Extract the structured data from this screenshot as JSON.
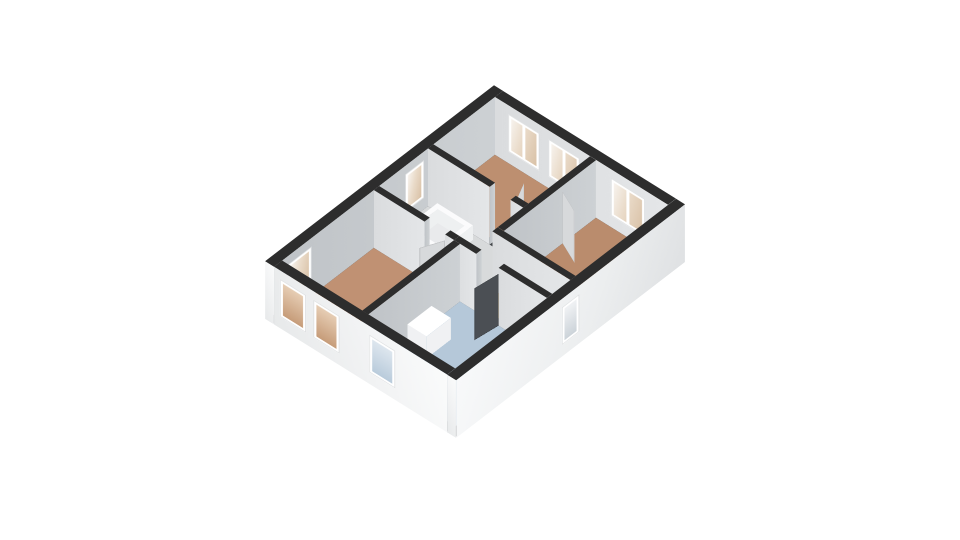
{
  "scene": {
    "background": "#ffffff",
    "projection": {
      "origin_x": 494,
      "origin_y": 143,
      "rotate_x_deg": 46.2,
      "rotate_z_deg": 42,
      "wall_height": 80
    },
    "palette": {
      "wall_top": "#2d2d2d",
      "stair_top": "#fbfbfc",
      "stair_face": "#eef0f1",
      "vanity_top": "#ffffff",
      "vanity_face": "#f0f1f3",
      "int_x": "linear-gradient(90deg,#bfc3c7,#cdd1d4)",
      "int_y": "linear-gradient(90deg,#dadcde,#e4e6e8)",
      "ext_x": "linear-gradient(115deg,#f8f9fa 0%,#eceeef 60%,#dfe1e3 100%)",
      "ext_y": "linear-gradient(65deg,#e7e9ea 0%,#f2f3f4 55%,#fafbfb 100%)",
      "floor_bedroom_top": "#bd8f70",
      "floor_bedroom_right": "#ba8c6d",
      "floor_bedroom_left": "#c09173",
      "floor_bathroom": "#b5c8d9",
      "floor_hallway": "#e2a33e",
      "floor_landing": "#d8dadb",
      "floor_stair_opening": "#e9eaec",
      "slab_shadow": "#43464a",
      "door_light": "#d7d9db",
      "door_dark": "#4b4f54",
      "window_frame": "#ffffff",
      "glass_warm": "linear-gradient(105deg,#f7f3ee 0%,#e9dac8 45%,#d9c1a6 100%)",
      "glass_tan": "linear-gradient(180deg,#e6cdb4,#c69c79)",
      "glass_blue": "linear-gradient(180deg,#dde6ee,#b9cbdb)",
      "glass_cool": "linear-gradient(180deg,#f0f2f4,#ccd3d9)"
    },
    "slab": {
      "name": "foundation-slab",
      "x": 2,
      "y": 2,
      "w": 253,
      "d": 338,
      "z": -0.6,
      "color": "slab_shadow"
    },
    "floors": [
      {
        "name": "floor-bedroom-top",
        "x": 12,
        "y": 12,
        "w": 128,
        "d": 92,
        "color": "floor_bedroom_top"
      },
      {
        "name": "floor-bedroom-right",
        "x": 148,
        "y": 12,
        "w": 97,
        "d": 138,
        "color": "floor_bedroom_right"
      },
      {
        "name": "floor-landing",
        "x": 12,
        "y": 112,
        "w": 128,
        "d": 73,
        "color": "floor_landing"
      },
      {
        "name": "floor-hallway",
        "x": 140,
        "y": 158,
        "w": 105,
        "d": 27,
        "color": "floor_hallway"
      },
      {
        "name": "floor-bedroom-left",
        "x": 12,
        "y": 193,
        "w": 108,
        "d": 137,
        "color": "floor_bedroom_left"
      },
      {
        "name": "floor-bathroom",
        "x": 128,
        "y": 193,
        "w": 117,
        "d": 137,
        "color": "floor_bathroom"
      },
      {
        "name": "floor-stair-opening",
        "x": 36,
        "y": 124,
        "w": 36,
        "d": 38,
        "z": 0.6,
        "color": "floor_stair_opening"
      }
    ],
    "walls": [
      {
        "name": "wall-exterior-north",
        "x": 12,
        "y": 0,
        "w": 233,
        "d": 12,
        "face_x": "int_x",
        "face_y": "int_y"
      },
      {
        "name": "wall-exterior-west",
        "x": 0,
        "y": 0,
        "w": 12,
        "d": 342,
        "face_x": "int_x",
        "face_y": "ext_y"
      },
      {
        "name": "wall-exterior-south",
        "x": 12,
        "y": 330,
        "w": 233,
        "d": 12,
        "face_x": "int_x",
        "face_y": "ext_y"
      },
      {
        "name": "wall-exterior-east",
        "x": 245,
        "y": 0,
        "w": 12,
        "d": 342,
        "face_x": "ext_x",
        "face_y": "ext_y"
      },
      {
        "name": "wall-bedrooms-partition",
        "x": 140,
        "y": 12,
        "w": 8,
        "d": 138,
        "face_x": "int_x",
        "face_y": "int_y"
      },
      {
        "name": "wall-bedroom-top-south-a",
        "x": 12,
        "y": 104,
        "w": 83,
        "d": 8,
        "face_x": "int_x",
        "face_y": "int_y"
      },
      {
        "name": "wall-bedroom-top-south-b",
        "x": 123,
        "y": 104,
        "w": 17,
        "d": 8,
        "face_x": "int_x",
        "face_y": "int_y"
      },
      {
        "name": "wall-hallway-north",
        "x": 140,
        "y": 150,
        "w": 105,
        "d": 8,
        "face_x": "int_x",
        "face_y": "int_y"
      },
      {
        "name": "wall-bedroom-left-north-a",
        "x": 12,
        "y": 185,
        "w": 68,
        "d": 8,
        "face_x": "int_x",
        "face_y": "int_y"
      },
      {
        "name": "wall-bedroom-left-north-b",
        "x": 108,
        "y": 185,
        "w": 12,
        "d": 8,
        "face_x": "int_x",
        "face_y": "int_y"
      },
      {
        "name": "wall-bathroom-north-a",
        "x": 120,
        "y": 185,
        "w": 30,
        "d": 8,
        "face_x": "int_x",
        "face_y": "int_y"
      },
      {
        "name": "wall-bathroom-north-b",
        "x": 180,
        "y": 185,
        "w": 65,
        "d": 8,
        "face_x": "int_x",
        "face_y": "int_y"
      },
      {
        "name": "wall-bathroom-west",
        "x": 120,
        "y": 193,
        "w": 8,
        "d": 137,
        "face_x": "int_x",
        "face_y": "int_y"
      },
      {
        "name": "stair-opening-rim-north",
        "x": 30,
        "y": 118,
        "w": 48,
        "d": 6,
        "h": 20,
        "top": "stair_top",
        "face_x": "stair_face",
        "face_y": "stair_face"
      },
      {
        "name": "stair-opening-rim-south",
        "x": 30,
        "y": 162,
        "w": 48,
        "d": 6,
        "h": 20,
        "top": "stair_top",
        "face_x": "stair_face",
        "face_y": "stair_face"
      },
      {
        "name": "stair-opening-rim-west",
        "x": 30,
        "y": 124,
        "w": 6,
        "d": 38,
        "h": 20,
        "top": "stair_top",
        "face_x": "stair_face",
        "face_y": "stair_face"
      },
      {
        "name": "stair-opening-rim-east",
        "x": 72,
        "y": 124,
        "w": 6,
        "d": 38,
        "h": 20,
        "top": "stair_top",
        "face_x": "stair_face",
        "face_y": "stair_face"
      },
      {
        "name": "bathroom-vanity",
        "x": 132,
        "y": 240,
        "w": 26,
        "d": 36,
        "h": 30,
        "top": "vanity_top",
        "face_x": "vanity_face",
        "face_y": "vanity_face"
      }
    ],
    "windows": [
      {
        "name": "window-bedroom-top-1",
        "wall": "wall-exterior-north",
        "face": "y",
        "off": 18,
        "w": 42,
        "glass": "glass_warm"
      },
      {
        "name": "window-bedroom-top-2",
        "wall": "wall-exterior-north",
        "face": "y",
        "off": 72,
        "w": 42,
        "glass": "glass_warm"
      },
      {
        "name": "window-bedroom-right",
        "wall": "wall-exterior-north",
        "face": "y",
        "off": 156,
        "w": 46,
        "glass": "glass_warm"
      },
      {
        "name": "window-landing-side",
        "wall": "wall-exterior-west",
        "face": "x",
        "off": 118,
        "w": 28,
        "glass": "glass_warm"
      },
      {
        "name": "window-bedroom-left-side",
        "wall": "wall-exterior-west",
        "face": "x",
        "off": 286,
        "w": 36,
        "glass": "glass_warm"
      },
      {
        "name": "window-bedroom-left-1",
        "wall": "wall-exterior-south",
        "face": "y",
        "off": 8,
        "w": 35,
        "glass": "glass_tan"
      },
      {
        "name": "window-bedroom-left-2",
        "wall": "wall-exterior-south",
        "face": "y",
        "off": 53,
        "w": 35,
        "glass": "glass_tan"
      },
      {
        "name": "window-bathroom",
        "wall": "wall-exterior-south",
        "face": "y",
        "off": 128,
        "w": 35,
        "glass": "glass_blue"
      },
      {
        "name": "window-hallway",
        "wall": "wall-exterior-east",
        "face": "x",
        "off": 158,
        "w": 26,
        "glass": "glass_cool"
      }
    ],
    "doors": [
      {
        "name": "door-bathroom",
        "hinge_x": 180,
        "hinge_y": 193,
        "angle_deg": 97,
        "len": 32,
        "h": 72,
        "color": "door_dark"
      },
      {
        "name": "door-bedroom-top",
        "hinge_x": 123,
        "hinge_y": 104,
        "angle_deg": -115,
        "len": 28,
        "h": 72,
        "color": "door_light"
      },
      {
        "name": "door-bedroom-right",
        "hinge_x": 148,
        "hinge_y": 62,
        "angle_deg": 25,
        "len": 30,
        "h": 72,
        "color": "door_light"
      },
      {
        "name": "door-bedroom-left",
        "hinge_x": 108,
        "hinge_y": 193,
        "angle_deg": 115,
        "len": 28,
        "h": 72,
        "color": "door_light"
      }
    ]
  }
}
